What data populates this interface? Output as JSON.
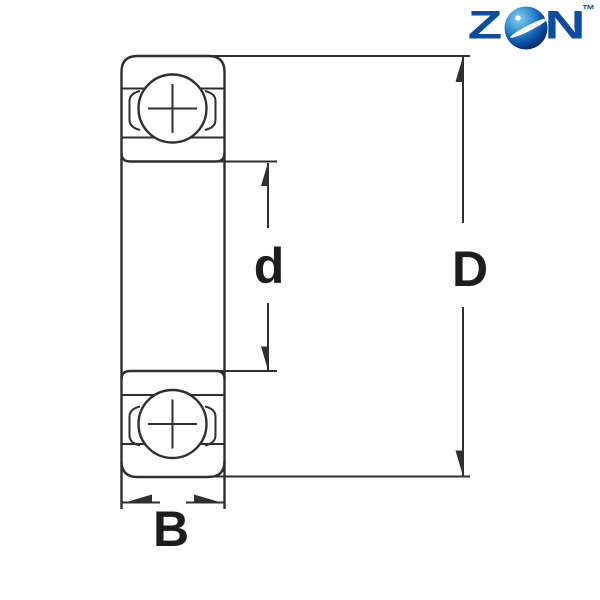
{
  "brand": {
    "wordmark_z": "Z",
    "wordmark_n": "N",
    "trademark": "™",
    "brand_blue": "#0d4da0",
    "ball_highlight": "#8ed0f0",
    "ball_dark": "#07295f"
  },
  "diagram": {
    "type": "bearing-cross-section-dimension-drawing",
    "labels": {
      "bore_diameter": "d",
      "outer_diameter": "D",
      "width": "B"
    },
    "line_color": "#2f2f2f",
    "label_color": "#1d1d1d"
  }
}
